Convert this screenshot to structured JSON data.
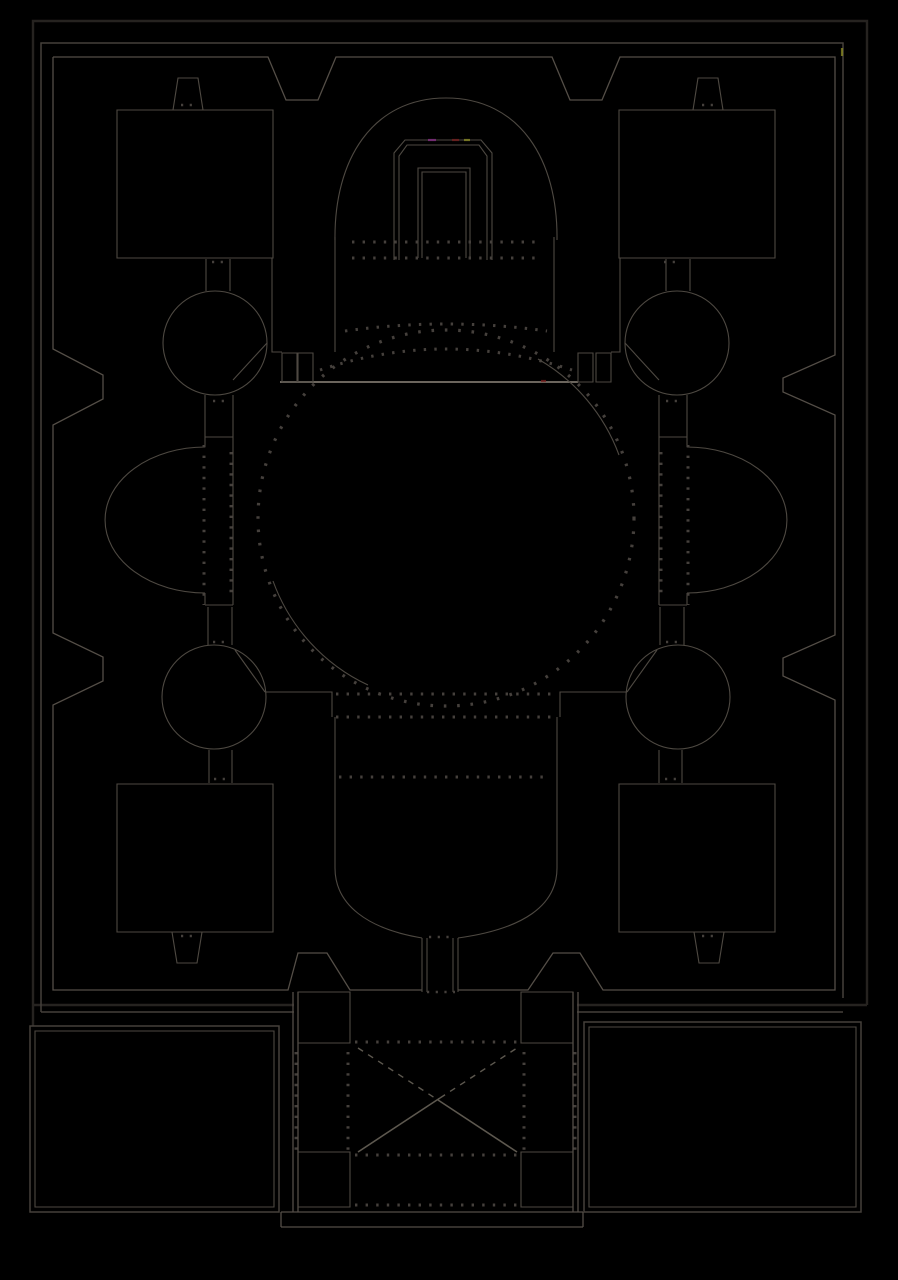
{
  "canvas": {
    "width": 898,
    "height": 1280,
    "background": "#000000"
  },
  "colors": {
    "background": "#000000",
    "outer_wall": "#262320",
    "wall": "#45403a",
    "inner_face": "#544e47",
    "line": "#4e4942",
    "line_bright": "#6b655d",
    "cross_line": "#5d584f",
    "dots": "#45403c",
    "artifact_red": "#7a1f1f",
    "artifact_magenta": "#8a2f8a",
    "artifact_yellow": "#8f8f25"
  },
  "plan": {
    "type": "architectural floor plan",
    "subject": "domed cruciform church plan drawn as light linework on black",
    "orientation": "entrance narthex at bottom, sanctuary apse at top",
    "symmetry": "bilateral about vertical axis",
    "features": [
      {
        "name": "outer-precinct-wall",
        "desc": "triple-line rectangular enclosure with trapezoidal notches on all four sides"
      },
      {
        "name": "corner-chambers",
        "count": 4,
        "desc": "square rooms in each corner with trapezoid wall passages"
      },
      {
        "name": "stair-towers",
        "count": 4,
        "desc": "circular chambers on the diagonals, chamfered toward the naos"
      },
      {
        "name": "lateral-apses",
        "count": 2,
        "desc": "semicircular exedrae east and west with dotted column screens"
      },
      {
        "name": "sanctuary-apse",
        "desc": "horseshoe arch at top containing a double-walled U enclosure and dotted step arcs"
      },
      {
        "name": "templon-line",
        "desc": "bright chord line with four pilaster blocks at the dome's north edge"
      },
      {
        "name": "naos-dome",
        "desc": "large dotted circle, radius ~188 px, centered on the crossing"
      },
      {
        "name": "south-arm",
        "desc": "bullet-shaped bay narrowing to a corridor through the south wall"
      },
      {
        "name": "narthex",
        "desc": "projecting bay with four corner cells and an X-vaulted central hall"
      },
      {
        "name": "courtyard-wings",
        "count": 2,
        "desc": "plain double-lined rectangular enclosures flanking the narthex"
      }
    ]
  }
}
